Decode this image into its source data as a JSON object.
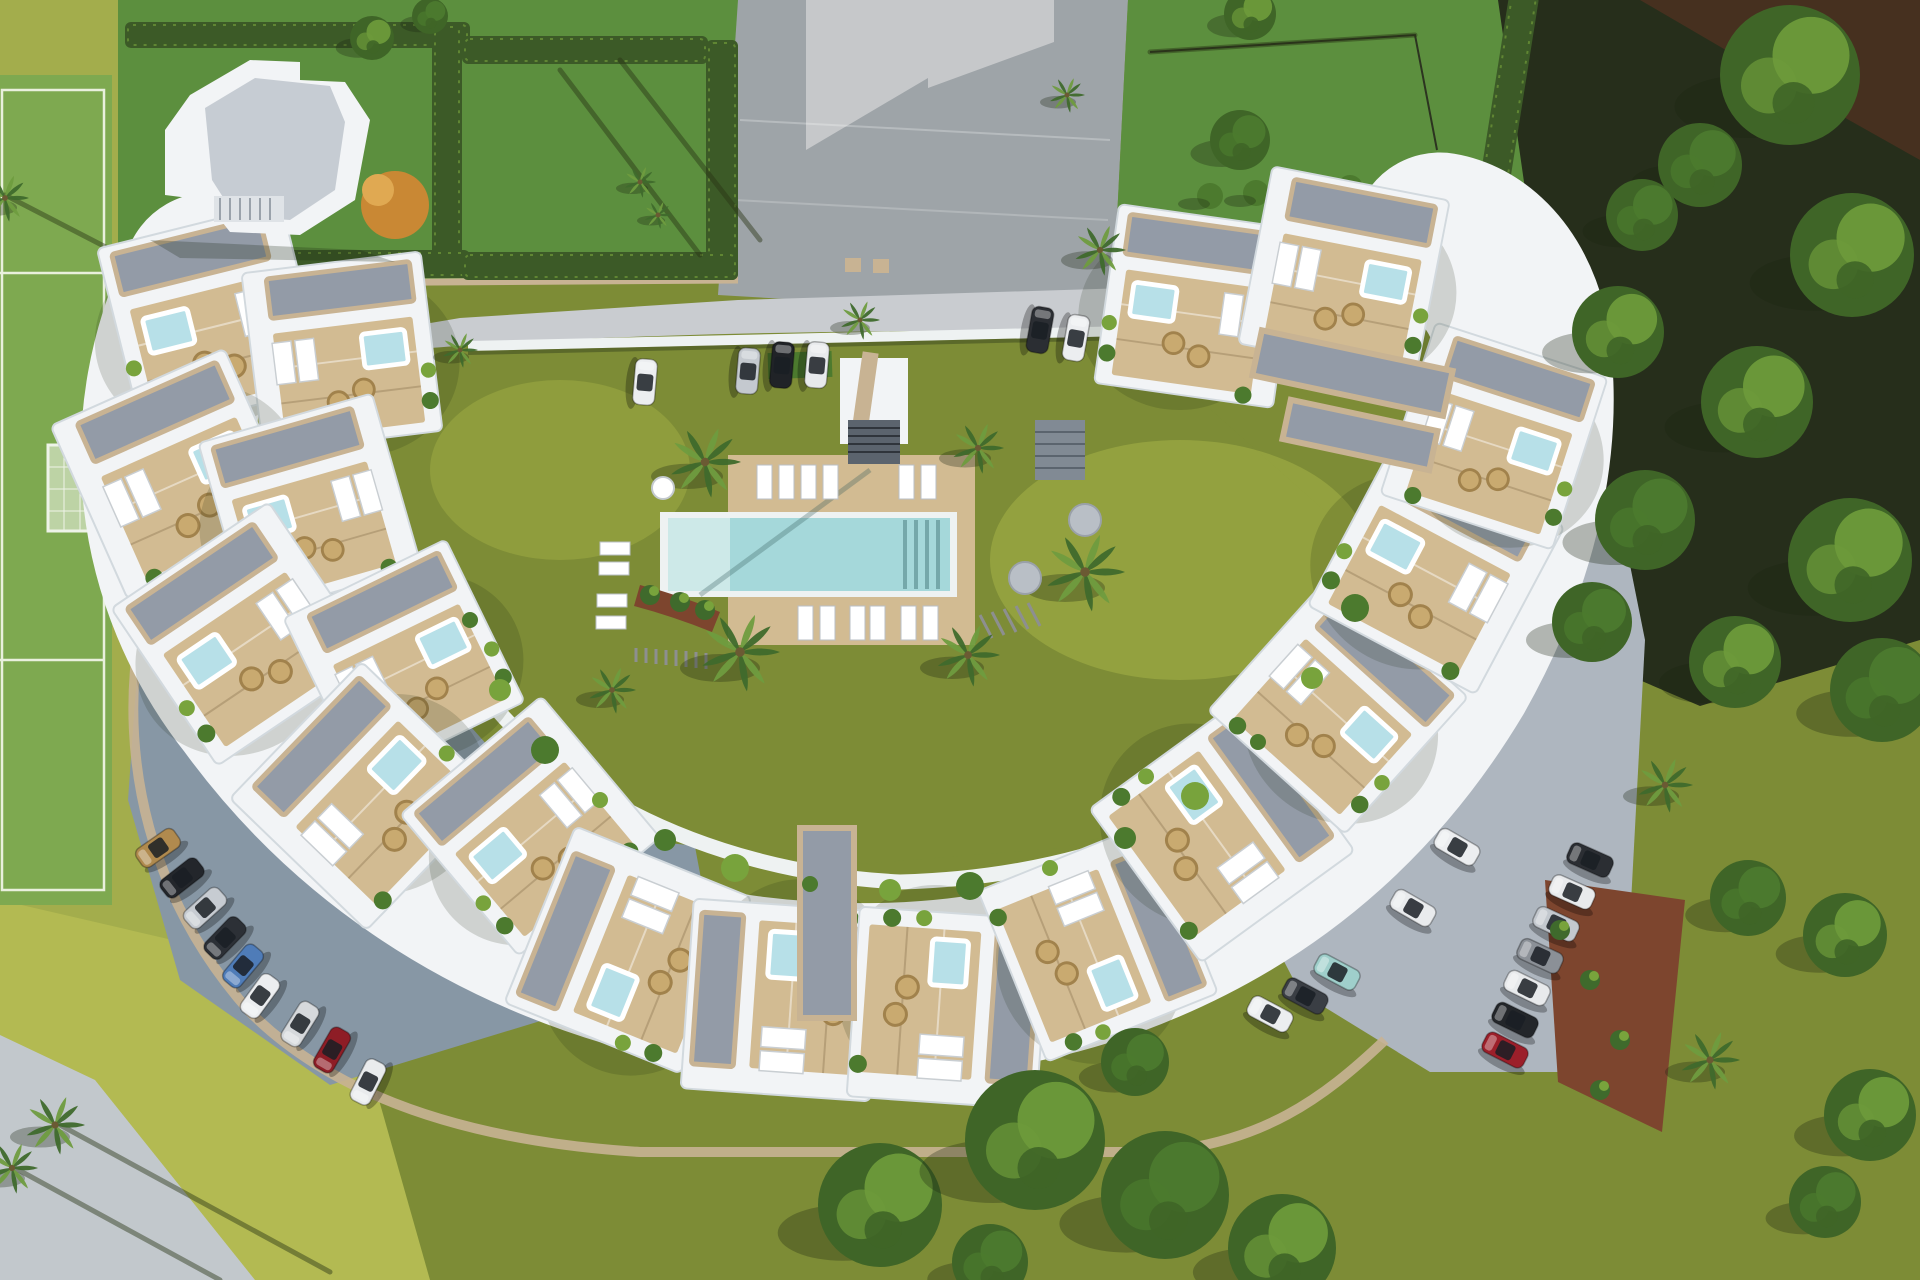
{
  "scene": {
    "type": "aerial-architectural-render",
    "subject": "crescent-shaped residential complex with central pool courtyard, sports field, parking lots and woodland",
    "villa_module_count": 18,
    "palette": {
      "grass_left": "#a3ad4c",
      "grass_sun": "#b3ba52",
      "grass_plot": "#5c8f3e",
      "grass_olive": "#7d8c36",
      "court_green": "#7ea950",
      "field_line": "#e9f0dd",
      "hedge": "#3c5a27",
      "road_light": "#c9ccd0",
      "driveway": "#9ea4a8",
      "drive_pale": "#c6c8ca",
      "parking_blue": "#8797a5",
      "parking_right": "#aeb6bf",
      "path_gray": "#c2c8cc",
      "wall_beige": "#c8b393",
      "mulch": "#7d452e",
      "building_white": "#f2f4f6",
      "building_edge": "#d2d9de",
      "pebble_roof": "#939ba7",
      "deck": "#d2bb92",
      "pool_rim": "#eef2f2",
      "pool_water": "#a5d8da",
      "pool_steps": "#cde9e8",
      "jacuzzi": "#b7e0e8",
      "plant_dark": "#3f6a2c",
      "plant_mid": "#4c7a2e",
      "plant_light": "#78a33c",
      "palm_green": "#6f9c3f",
      "forest_floor": "#262e1b",
      "soil": "#46301f",
      "canopy_dark": "#3f6527",
      "canopy_light": "#6d9a3a",
      "orange_tree": "#c98834",
      "wicker": "#c9aa70",
      "shadow": "rgba(25,35,15,0.30)"
    }
  },
  "courtyard": {
    "loungers_top_row": [
      [
        757,
        465
      ],
      [
        779,
        465
      ],
      [
        801,
        465
      ],
      [
        823,
        465
      ],
      [
        899,
        465
      ],
      [
        921,
        465
      ]
    ],
    "loungers_bottom_row": [
      [
        798,
        606
      ],
      [
        820,
        606
      ],
      [
        850,
        606
      ],
      [
        870,
        606
      ],
      [
        901,
        606
      ],
      [
        923,
        606
      ]
    ],
    "loungers_left_col": [
      [
        600,
        542
      ],
      [
        599,
        562
      ],
      [
        597,
        594
      ],
      [
        596,
        616
      ]
    ],
    "round_table": [
      663,
      488,
      11
    ],
    "gray_platforms": [
      [
        1085,
        520,
        16
      ],
      [
        1025,
        578,
        16
      ]
    ]
  },
  "cars": {
    "top_road": [
      {
        "x": 645,
        "y": 382,
        "rot": 95,
        "color": "#eceef0"
      },
      {
        "x": 748,
        "y": 371,
        "rot": 95,
        "color": "#c4c9cf"
      },
      {
        "x": 782,
        "y": 365,
        "rot": 95,
        "color": "#202327"
      },
      {
        "x": 817,
        "y": 365,
        "rot": 95,
        "color": "#e8eaec"
      },
      {
        "x": 1040,
        "y": 330,
        "rot": 100,
        "color": "#2b2e33"
      },
      {
        "x": 1076,
        "y": 338,
        "rot": 100,
        "color": "#eceef0"
      }
    ],
    "bottom_left": [
      {
        "x": 158,
        "y": 848,
        "rot": -35,
        "color": "#b08a4e"
      },
      {
        "x": 182,
        "y": 878,
        "rot": -38,
        "color": "#23262b"
      },
      {
        "x": 205,
        "y": 908,
        "rot": -42,
        "color": "#c7ccd2"
      },
      {
        "x": 225,
        "y": 938,
        "rot": -46,
        "color": "#2c3036"
      },
      {
        "x": 243,
        "y": 966,
        "rot": -50,
        "color": "#4f7cb8"
      },
      {
        "x": 260,
        "y": 996,
        "rot": -54,
        "color": "#eceef0"
      },
      {
        "x": 300,
        "y": 1024,
        "rot": -58,
        "color": "#d6d9dc"
      },
      {
        "x": 332,
        "y": 1050,
        "rot": -60,
        "color": "#8e1d26"
      },
      {
        "x": 368,
        "y": 1082,
        "rot": -63,
        "color": "#e9ebed"
      }
    ],
    "right_outer": [
      {
        "x": 1590,
        "y": 860,
        "rot": 24,
        "color": "#2b2e33"
      },
      {
        "x": 1572,
        "y": 892,
        "rot": 24,
        "color": "#e8eaec"
      },
      {
        "x": 1556,
        "y": 924,
        "rot": 25,
        "color": "#c3c8ce"
      },
      {
        "x": 1540,
        "y": 956,
        "rot": 25,
        "color": "#8b9097"
      },
      {
        "x": 1527,
        "y": 988,
        "rot": 26,
        "color": "#e8eaec"
      },
      {
        "x": 1515,
        "y": 1020,
        "rot": 26,
        "color": "#23262a"
      },
      {
        "x": 1505,
        "y": 1050,
        "rot": 27,
        "color": "#9c1f2a"
      }
    ],
    "right_inner": [
      {
        "x": 1457,
        "y": 847,
        "rot": 30,
        "color": "#eceef0"
      },
      {
        "x": 1413,
        "y": 908,
        "rot": 30,
        "color": "#e9ebed"
      },
      {
        "x": 1337,
        "y": 972,
        "rot": 28,
        "color": "#9fcfcb"
      },
      {
        "x": 1305,
        "y": 996,
        "rot": 28,
        "color": "#3a3e44"
      },
      {
        "x": 1270,
        "y": 1014,
        "rot": 28,
        "color": "#eceef0"
      }
    ]
  },
  "palms": [
    [
      705,
      462,
      36
    ],
    [
      740,
      652,
      40
    ],
    [
      968,
      655,
      32
    ],
    [
      978,
      448,
      26
    ],
    [
      1085,
      572,
      40
    ],
    [
      612,
      690,
      24
    ],
    [
      1100,
      250,
      26
    ],
    [
      1067,
      95,
      18
    ],
    [
      640,
      182,
      16
    ],
    [
      658,
      215,
      14
    ],
    [
      5,
      198,
      24
    ],
    [
      55,
      1125,
      30
    ],
    [
      12,
      1168,
      26
    ],
    [
      1665,
      785,
      28
    ],
    [
      1710,
      1060,
      30
    ],
    [
      860,
      320,
      20
    ],
    [
      460,
      350,
      18
    ]
  ],
  "trees": [
    {
      "x": 1790,
      "y": 75,
      "r": 70,
      "light": true
    },
    {
      "x": 1700,
      "y": 165,
      "r": 42,
      "light": false
    },
    {
      "x": 1852,
      "y": 255,
      "r": 62,
      "light": true
    },
    {
      "x": 1642,
      "y": 215,
      "r": 36,
      "light": false
    },
    {
      "x": 1618,
      "y": 332,
      "r": 46,
      "light": true
    },
    {
      "x": 1757,
      "y": 402,
      "r": 56,
      "light": true
    },
    {
      "x": 1645,
      "y": 520,
      "r": 50,
      "light": false
    },
    {
      "x": 1850,
      "y": 560,
      "r": 62,
      "light": true
    },
    {
      "x": 1592,
      "y": 622,
      "r": 40,
      "light": false
    },
    {
      "x": 1735,
      "y": 662,
      "r": 46,
      "light": true
    },
    {
      "x": 1882,
      "y": 690,
      "r": 52,
      "light": false
    },
    {
      "x": 1845,
      "y": 935,
      "r": 42,
      "light": true
    },
    {
      "x": 1748,
      "y": 898,
      "r": 38,
      "light": false
    },
    {
      "x": 1870,
      "y": 1115,
      "r": 46,
      "light": true
    },
    {
      "x": 1825,
      "y": 1202,
      "r": 36,
      "light": false
    },
    {
      "x": 880,
      "y": 1205,
      "r": 62,
      "light": true
    },
    {
      "x": 1035,
      "y": 1140,
      "r": 70,
      "light": true
    },
    {
      "x": 1165,
      "y": 1195,
      "r": 64,
      "light": false
    },
    {
      "x": 1282,
      "y": 1248,
      "r": 54,
      "light": true
    },
    {
      "x": 1135,
      "y": 1062,
      "r": 34,
      "light": false
    },
    {
      "x": 990,
      "y": 1262,
      "r": 38,
      "light": false
    },
    {
      "x": 372,
      "y": 38,
      "r": 22,
      "light": true
    },
    {
      "x": 430,
      "y": 16,
      "r": 18,
      "light": false
    },
    {
      "x": 1240,
      "y": 140,
      "r": 30,
      "light": false
    },
    {
      "x": 1250,
      "y": 14,
      "r": 26,
      "light": true
    }
  ],
  "hedges": [
    [
      125,
      22,
      345,
      26,
      0
    ],
    [
      432,
      24,
      30,
      252,
      0
    ],
    [
      120,
      250,
      350,
      28,
      0
    ],
    [
      462,
      36,
      246,
      28,
      0
    ],
    [
      706,
      40,
      32,
      240,
      0
    ],
    [
      462,
      252,
      276,
      28,
      0
    ],
    [
      1490,
      -8,
      30,
      250,
      9
    ]
  ],
  "shrub_row_top_right": [
    [
      1210,
      196
    ],
    [
      1256,
      193
    ],
    [
      1302,
      190
    ],
    [
      1350,
      188
    ],
    [
      1398,
      186
    ]
  ],
  "villas": [
    {
      "x": 212,
      "y": 318,
      "rot": -14,
      "s": 1.0,
      "m": 0
    },
    {
      "x": 342,
      "y": 352,
      "rot": -7,
      "s": 0.95,
      "m": 1
    },
    {
      "x": 176,
      "y": 474,
      "rot": -24,
      "s": 1.0,
      "m": 1
    },
    {
      "x": 310,
      "y": 505,
      "rot": -16,
      "s": 0.95,
      "m": 0
    },
    {
      "x": 243,
      "y": 634,
      "rot": -34,
      "s": 1.0,
      "m": 0
    },
    {
      "x": 404,
      "y": 660,
      "rot": -26,
      "s": 0.95,
      "m": 1
    },
    {
      "x": 364,
      "y": 796,
      "rot": -46,
      "s": 1.0,
      "m": 1
    },
    {
      "x": 530,
      "y": 826,
      "rot": -40,
      "s": 0.97,
      "m": 0
    },
    {
      "x": 628,
      "y": 950,
      "rot": -68,
      "s": 1.0,
      "m": 0
    },
    {
      "x": 782,
      "y": 1000,
      "rot": -86,
      "s": 1.0,
      "m": 1
    },
    {
      "x": 948,
      "y": 1008,
      "rot": 94,
      "s": 1.0,
      "m": 0
    },
    {
      "x": 1098,
      "y": 942,
      "rot": 68,
      "s": 0.97,
      "m": 1
    },
    {
      "x": 1222,
      "y": 830,
      "rot": 54,
      "s": 1.0,
      "m": 0
    },
    {
      "x": 1338,
      "y": 704,
      "rot": 42,
      "s": 0.97,
      "m": 1
    },
    {
      "x": 1436,
      "y": 566,
      "rot": 28,
      "s": 1.0,
      "m": 0
    },
    {
      "x": 1494,
      "y": 436,
      "rot": 18,
      "s": 0.95,
      "m": 1
    },
    {
      "x": 1196,
      "y": 306,
      "rot": 8,
      "s": 0.95,
      "m": 0
    },
    {
      "x": 1344,
      "y": 272,
      "rot": 11,
      "s": 0.95,
      "m": 1
    }
  ],
  "walkway_plants": [
    [
      470,
      620
    ],
    [
      500,
      690
    ],
    [
      545,
      750
    ],
    [
      600,
      800
    ],
    [
      665,
      840
    ],
    [
      735,
      868
    ],
    [
      810,
      884
    ],
    [
      890,
      890
    ],
    [
      970,
      886
    ],
    [
      1050,
      868
    ],
    [
      1125,
      838
    ],
    [
      1195,
      796
    ],
    [
      1258,
      742
    ],
    [
      1312,
      678
    ],
    [
      1355,
      608
    ]
  ],
  "shadow_streaks": [
    [
      5,
      195,
      425,
      412
    ],
    [
      60,
      1125,
      330,
      1272
    ],
    [
      15,
      1168,
      220,
      1280
    ],
    [
      560,
      70,
      700,
      255
    ],
    [
      620,
      60,
      760,
      240
    ],
    [
      1150,
      52,
      1415,
      35
    ]
  ]
}
